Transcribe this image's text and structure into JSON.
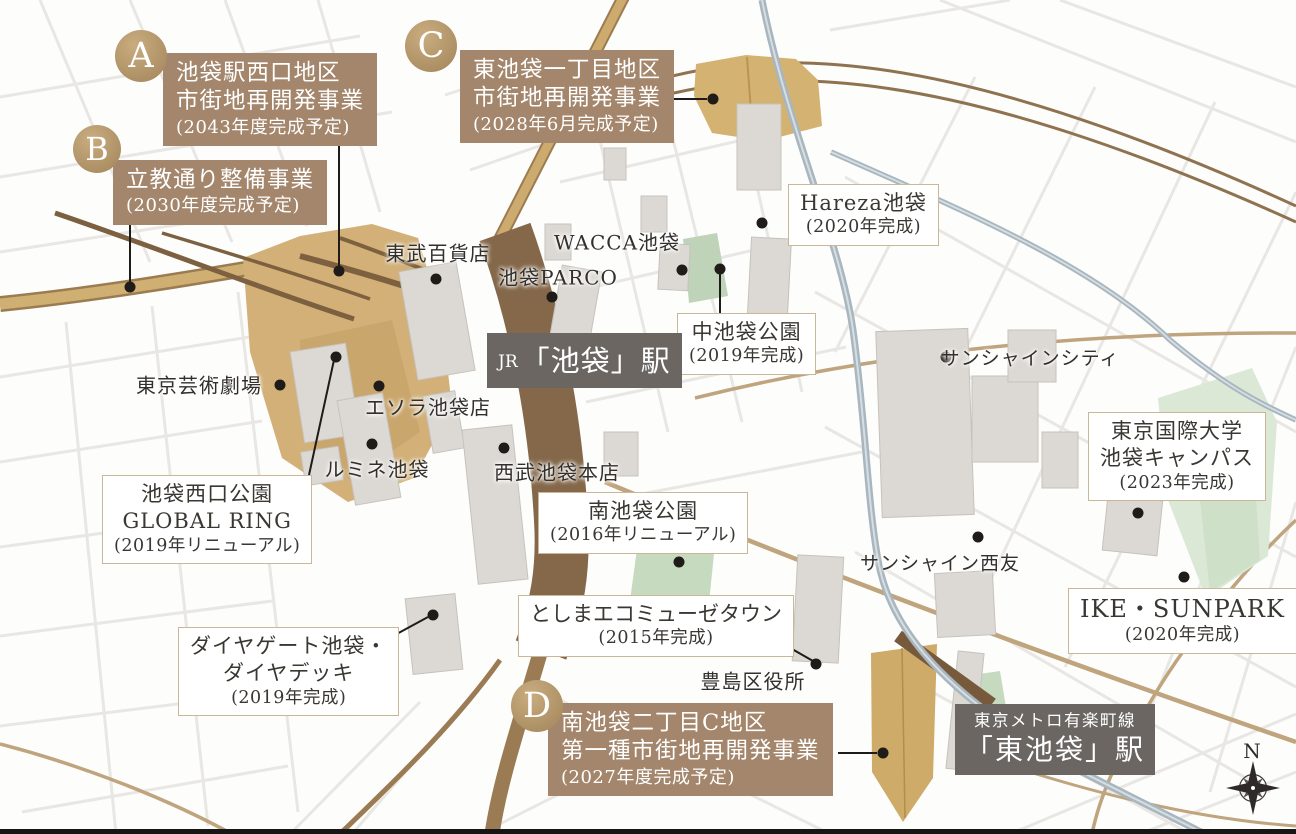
{
  "projects": {
    "a": {
      "letter": "A",
      "line1": "池袋駅西口地区",
      "line2": "市街地再開発事業",
      "date": "(2043年度完成予定)"
    },
    "b": {
      "letter": "B",
      "line1": "立教通り整備事業",
      "date": "(2030年度完成予定)"
    },
    "c": {
      "letter": "C",
      "line1": "東池袋一丁目地区",
      "line2": "市街地再開発事業",
      "date": "(2028年6月完成予定)"
    },
    "d": {
      "letter": "D",
      "line1": "南池袋二丁目C地区",
      "line2": "第一種市街地再開発事業",
      "date": "(2027年度完成予定)"
    }
  },
  "facilities": {
    "hareza": {
      "name": "Hareza池袋",
      "date": "(2020年完成)"
    },
    "naka_ikebukuro_park": {
      "name": "中池袋公園",
      "date": "(2019年完成)"
    },
    "nishiguchi_park": {
      "name": "池袋西口公園",
      "name2": "GLOBAL RING",
      "date": "(2019年リニューアル)"
    },
    "minami_ikebukuro_park": {
      "name": "南池袋公園",
      "date": "(2016年リニューアル)"
    },
    "ecomusee_town": {
      "name": "としまエコミューゼタウン",
      "date": "(2015年完成)"
    },
    "diagate": {
      "name": "ダイヤゲート池袋・",
      "name2": "ダイヤデッキ",
      "date": "(2019年完成)"
    },
    "tiu_campus": {
      "name": "東京国際大学",
      "name2": "池袋キャンパス",
      "date": "(2023年完成)"
    },
    "ike_sunpark": {
      "name": "IKE・SUNPARK",
      "date": "(2020年完成)"
    }
  },
  "places": {
    "tobu": "東武百貨店",
    "parco": "池袋PARCO",
    "wacca": "WACCA池袋",
    "geijutsu_gekijo": "東京芸術劇場",
    "esola": "エソラ池袋店",
    "lumine": "ルミネ池袋",
    "seibu": "西武池袋本店",
    "sunshine_city": "サンシャインシティ",
    "sunshine_seiyu": "サンシャイン西友",
    "toshima_city_hall": "豊島区役所"
  },
  "stations": {
    "ikebukuro": {
      "prefix": "JR",
      "name": "「池袋」駅"
    },
    "higashi_ikebukuro": {
      "line": "東京メトロ有楽町線",
      "name": "「東池袋」駅"
    }
  },
  "compass": {
    "north": "N"
  },
  "colors": {
    "project_badge_gold": "#b3976b",
    "project_box_brown": "#a3866b",
    "station_badge_gray": "#6b6662",
    "redevelopment_zone_gold": "#d2b078",
    "park_green": "#c6dabf",
    "jr_rail_brown": "#9a7b54",
    "metro_line_blue": "#a7b6bf",
    "road_tan": "#bfa47d",
    "label_box_border": "#c9b798"
  }
}
